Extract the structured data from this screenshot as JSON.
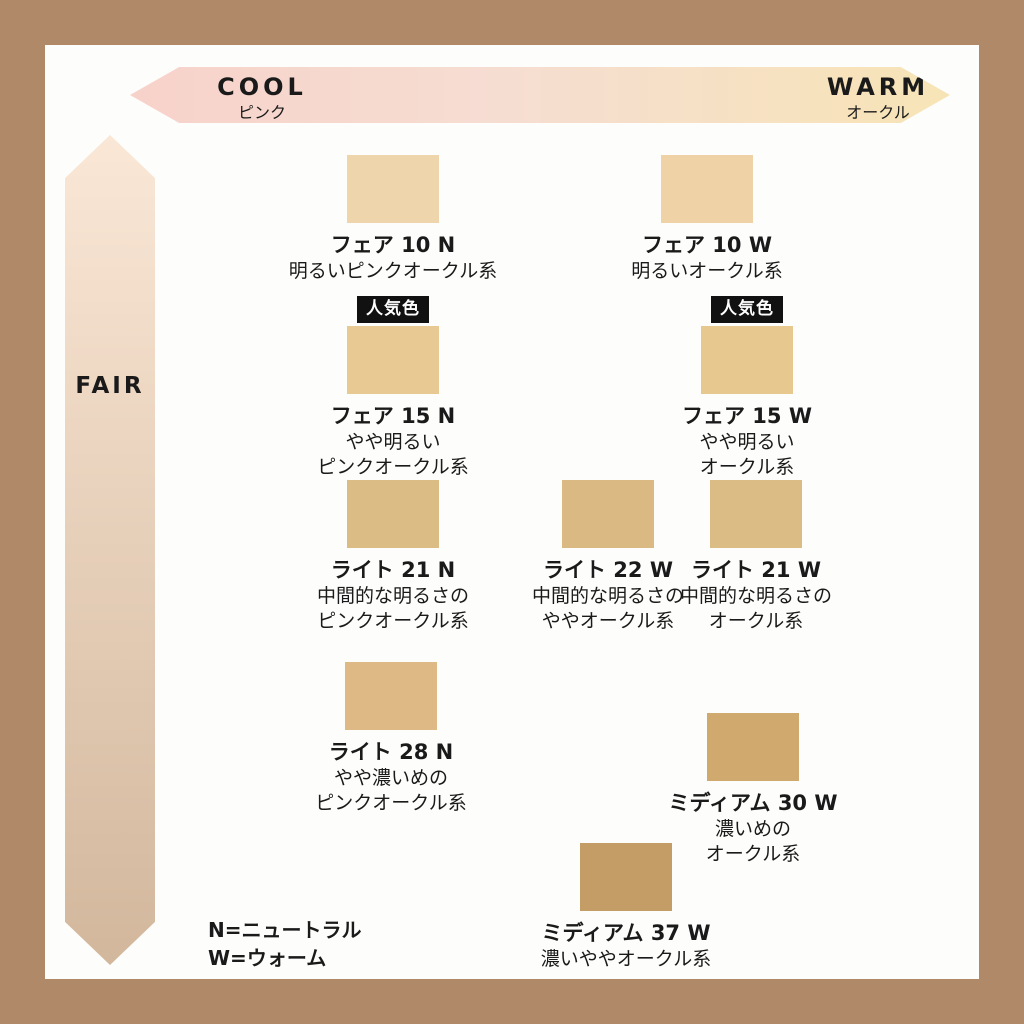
{
  "frame": {
    "border_color": "#b08a68",
    "background": "#fdfdfb"
  },
  "axes": {
    "horizontal": {
      "left_label": "COOL",
      "left_sublabel": "ピンク",
      "right_label": "WARM",
      "right_sublabel": "オークル",
      "gradient_left": "#f7d2ca",
      "gradient_mid": "#f6ddd2",
      "gradient_right": "#f7e4b6"
    },
    "vertical": {
      "top_label": "FAIR",
      "bottom_label": "TAN",
      "gradient_top": "#fae7d6",
      "gradient_bottom": "#d2b79c"
    }
  },
  "badge": {
    "label": "人気色",
    "background": "#111111",
    "text_color": "#ffffff"
  },
  "shades": [
    {
      "name": "フェア 10 N",
      "desc": [
        "明るいピンクオークル系"
      ],
      "color": "#eed5ab",
      "popular": false
    },
    {
      "name": "フェア 10 W",
      "desc": [
        "明るいオークル系"
      ],
      "color": "#efd2a6",
      "popular": false
    },
    {
      "name": "フェア 15 N",
      "desc": [
        "やや明るい",
        "ピンクオークル系"
      ],
      "color": "#e8c893",
      "popular": true
    },
    {
      "name": "フェア 15 W",
      "desc": [
        "やや明るい",
        "オークル系"
      ],
      "color": "#e7c88f",
      "popular": true
    },
    {
      "name": "ライト 21 N",
      "desc": [
        "中間的な明るさの",
        "ピンクオークル系"
      ],
      "color": "#dcbc85",
      "popular": false
    },
    {
      "name": "ライト 22 W",
      "desc": [
        "中間的な明るさの",
        "ややオークル系"
      ],
      "color": "#dbb982",
      "popular": false
    },
    {
      "name": "ライト 21 W",
      "desc": [
        "中間的な明るさの",
        "オークル系"
      ],
      "color": "#dcbc85",
      "popular": false
    },
    {
      "name": "ライト 28 N",
      "desc": [
        "やや濃いめの",
        "ピンクオークル系"
      ],
      "color": "#dfb985",
      "popular": false
    },
    {
      "name": "ミディアム 30 W",
      "desc": [
        "濃いめの",
        "オークル系"
      ],
      "color": "#d0a96f",
      "popular": false
    },
    {
      "name": "ミディアム 37 W",
      "desc": [
        "濃いややオークル系"
      ],
      "color": "#c49c66",
      "popular": false
    }
  ],
  "legend": {
    "neutral": "N=ニュートラル",
    "warm": "W=ウォーム"
  }
}
